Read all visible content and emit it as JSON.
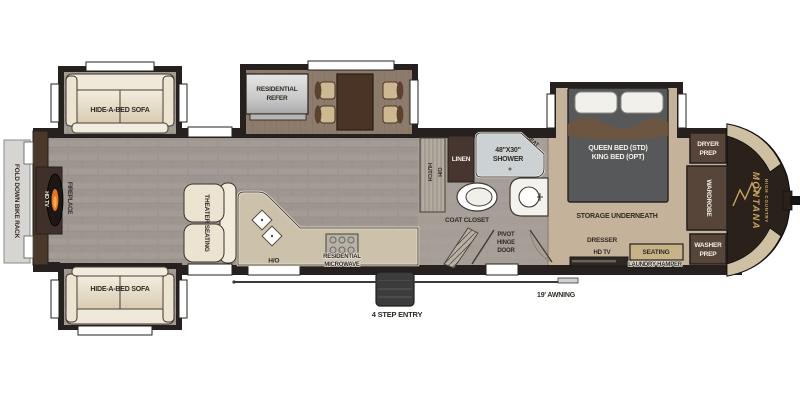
{
  "title": "Fifth wheel RV floor plan — Montana High Country",
  "labels": {
    "bike_rack": "FOLD DOWN BIKE RACK",
    "hd_tv_living": "HD TV",
    "fireplace": "FIREPLACE",
    "sofa_top": "HIDE-A-BED SOFA",
    "sofa_bottom": "HIDE-A-BED SOFA",
    "theater_seating": "THEATER SEATING",
    "refer_1": "RESIDENTIAL",
    "refer_2": "REFER",
    "oh_kitchen": "O/H",
    "microwave_1": "RESIDENTIAL",
    "microwave_2": "MICROWAVE",
    "hutch": "HUTCH",
    "oh_hutch": "O/H",
    "linen": "LINEN",
    "shower_1": "48\"X30\"",
    "shower_2": "SHOWER",
    "seat": "SEAT",
    "coat_closet": "COAT CLOSET",
    "pivot_1": "PIVOT",
    "pivot_2": "HINGE",
    "pivot_3": "DOOR",
    "bed_1": "QUEEN BED (STD)",
    "bed_2": "KING BED (OPT)",
    "storage": "STORAGE UNDERNEATH",
    "dresser": "DRESSER",
    "hd_tv_bedroom": "HD TV",
    "seating": "SEATING",
    "laundry_hamper": "LAUNDRY HAMPER",
    "dryer_1": "DRYER",
    "dryer_2": "PREP",
    "wardrobe": "WARDROBE",
    "washer_1": "WASHER",
    "washer_2": "PREP",
    "brand": "MONTANA",
    "brand_sub": "HIGH COUNTRY",
    "step_entry": "4 STEP ENTRY",
    "awning": "19' AWNING"
  },
  "colors": {
    "wall": "#26211e",
    "rear_wall": "#4a382b",
    "floor_plank": "#a39b95",
    "slide_wood": "#8d7c6c",
    "carpet": "#c5b29a",
    "counter": "#ccc2ab",
    "cabinet_dark": "#57453a",
    "linen_dark": "#473630",
    "shower": "#ccd2d3",
    "sofa_cream": "#ece3d0",
    "bed_gray": "#57585a",
    "blanket_brown": "#6f563f",
    "cap_brown": "#2a211b",
    "cap_accent": "#cec0a2",
    "brand_gold": "#c7a35f",
    "flame_orange": "#e8722a",
    "steps_gray": "#3c3c3c"
  }
}
